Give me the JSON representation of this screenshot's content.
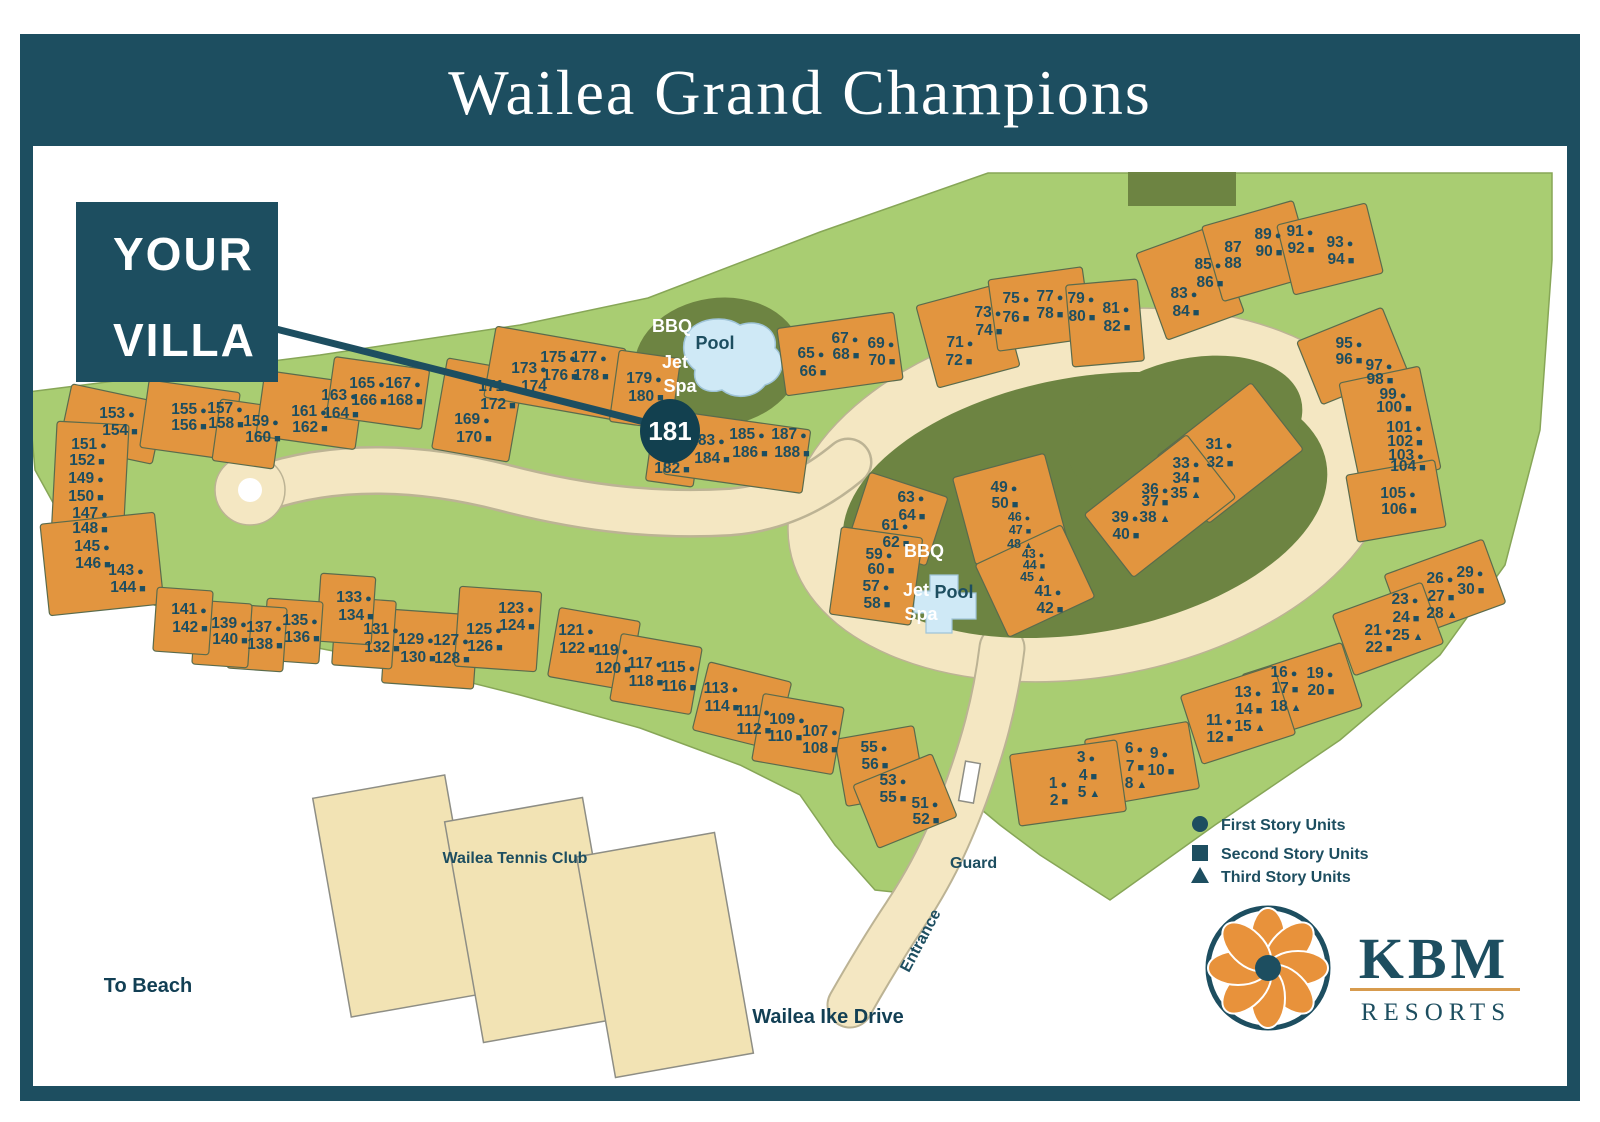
{
  "title": "Wailea Grand Champions",
  "callout": {
    "line1": "YOUR",
    "line2": "VILLA",
    "unit": "181"
  },
  "legend": [
    {
      "symbol": "circle",
      "label": "First Story Units"
    },
    {
      "symbol": "square",
      "label": "Second Story Units"
    },
    {
      "symbol": "triangle",
      "label": "Third Story Units"
    }
  ],
  "labels": {
    "bbq": "BBQ",
    "pool": "Pool",
    "jet": "Jet",
    "spa": "Spa",
    "tennis_club": "Wailea Tennis Club",
    "to_beach": "To Beach",
    "drive": "Wailea Ike Drive",
    "entrance": "Entrance",
    "guard": "Guard"
  },
  "logo": {
    "name": "KBM",
    "sub": "RESORTS"
  },
  "colors": {
    "header": "#1d4e60",
    "green": "#a9cd72",
    "green_edge": "#87a657",
    "olive": "#6d8442",
    "building": "#e2953f",
    "cream": "#f4e7c2",
    "pool": "#cfe9f6",
    "text": "#1d4e60",
    "logo_orange": "#e8923b"
  },
  "map": {
    "units": [
      [
        "1",
        1051,
        783,
        "c"
      ],
      [
        "2",
        1052,
        800,
        "s"
      ],
      [
        "3",
        1079,
        757,
        "c"
      ],
      [
        "4",
        1081,
        775,
        "s"
      ],
      [
        "5",
        1082,
        792,
        "t"
      ],
      [
        "6",
        1127,
        748,
        "c"
      ],
      [
        "7",
        1128,
        766,
        "s"
      ],
      [
        "8",
        1129,
        783,
        "t"
      ],
      [
        "9",
        1152,
        753,
        "c"
      ],
      [
        "10",
        1154,
        770,
        "s"
      ],
      [
        "11",
        1212,
        720,
        "c"
      ],
      [
        "12",
        1213,
        737,
        "s"
      ],
      [
        "13",
        1241,
        692,
        "c"
      ],
      [
        "14",
        1242,
        709,
        "s"
      ],
      [
        "15",
        1243,
        726,
        "t"
      ],
      [
        "16",
        1277,
        672,
        "c"
      ],
      [
        "17",
        1278,
        688,
        "s"
      ],
      [
        "18",
        1279,
        706,
        "t"
      ],
      [
        "19",
        1313,
        673,
        "c"
      ],
      [
        "20",
        1314,
        690,
        "s"
      ],
      [
        "21",
        1371,
        630,
        "c"
      ],
      [
        "22",
        1372,
        647,
        "s"
      ],
      [
        "23",
        1398,
        599,
        "c"
      ],
      [
        "24",
        1399,
        617,
        "s"
      ],
      [
        "25",
        1401,
        635,
        "t"
      ],
      [
        "26",
        1433,
        578,
        "c"
      ],
      [
        "27",
        1434,
        596,
        "s"
      ],
      [
        "28",
        1435,
        613,
        "t"
      ],
      [
        "29",
        1463,
        572,
        "c"
      ],
      [
        "30",
        1464,
        589,
        "s"
      ],
      [
        "31",
        1212,
        444,
        "c"
      ],
      [
        "32",
        1213,
        462,
        "s"
      ],
      [
        "33",
        1179,
        463,
        "c"
      ],
      [
        "34",
        1179,
        478,
        "s"
      ],
      [
        "35",
        1179,
        493,
        "t"
      ],
      [
        "36",
        1148,
        489,
        "c"
      ],
      [
        "37",
        1148,
        501,
        "s"
      ],
      [
        "38",
        1148,
        517,
        "t"
      ],
      [
        "39",
        1118,
        517,
        "c"
      ],
      [
        "40",
        1119,
        534,
        "s"
      ],
      [
        "41",
        1041,
        591,
        "c"
      ],
      [
        "42",
        1043,
        608,
        "s"
      ],
      [
        "43",
        1026,
        553,
        "c",
        1
      ],
      [
        "44",
        1027,
        564,
        "s",
        1
      ],
      [
        "45",
        1026,
        576,
        "t",
        1
      ],
      [
        "46",
        1012,
        516,
        "c",
        1
      ],
      [
        "47",
        1013,
        529,
        "s",
        1
      ],
      [
        "48",
        1013,
        543,
        "t",
        1
      ],
      [
        "49",
        997,
        487,
        "c"
      ],
      [
        "50",
        998,
        503,
        "s"
      ],
      [
        "51",
        918,
        803,
        "c"
      ],
      [
        "52",
        919,
        819,
        "s"
      ],
      [
        "53",
        886,
        780,
        "c"
      ],
      [
        "55",
        886,
        797,
        "s"
      ],
      [
        "55",
        867,
        747,
        "c"
      ],
      [
        "56",
        868,
        764,
        "s"
      ],
      [
        "57",
        869,
        586,
        "c"
      ],
      [
        "58",
        870,
        603,
        "s"
      ],
      [
        "59",
        872,
        554,
        "c"
      ],
      [
        "60",
        874,
        569,
        "s"
      ],
      [
        "61",
        888,
        525,
        "c"
      ],
      [
        "62",
        889,
        542,
        "s"
      ],
      [
        "63",
        904,
        497,
        "c"
      ],
      [
        "64",
        905,
        515,
        "s"
      ],
      [
        "65",
        804,
        353,
        "c"
      ],
      [
        "66",
        806,
        371,
        "s"
      ],
      [
        "67",
        838,
        338,
        "c"
      ],
      [
        "68",
        839,
        354,
        "s"
      ],
      [
        "69",
        874,
        343,
        "c"
      ],
      [
        "70",
        875,
        360,
        "s"
      ],
      [
        "71",
        953,
        342,
        "c"
      ],
      [
        "72",
        952,
        360,
        "s"
      ],
      [
        "73",
        981,
        312,
        "c"
      ],
      [
        "74",
        982,
        330,
        "s"
      ],
      [
        "75",
        1009,
        298,
        "c"
      ],
      [
        "76",
        1009,
        317,
        "s"
      ],
      [
        "77",
        1043,
        296,
        "c"
      ],
      [
        "78",
        1043,
        313,
        "s"
      ],
      [
        "79",
        1074,
        298,
        "c"
      ],
      [
        "80",
        1075,
        316,
        "s"
      ],
      [
        "81",
        1109,
        308,
        "c"
      ],
      [
        "82",
        1110,
        326,
        "s"
      ],
      [
        "83",
        1177,
        293,
        "c"
      ],
      [
        "84",
        1179,
        311,
        "s"
      ],
      [
        "85",
        1201,
        264,
        "c"
      ],
      [
        "86",
        1203,
        282,
        "s"
      ],
      [
        "87",
        1226,
        247,
        ""
      ],
      [
        "88",
        1226,
        263,
        ""
      ],
      [
        "89",
        1261,
        234,
        "c"
      ],
      [
        "90",
        1262,
        251,
        "s"
      ],
      [
        "91",
        1293,
        231,
        "c"
      ],
      [
        "92",
        1294,
        248,
        "s"
      ],
      [
        "93",
        1333,
        242,
        "c"
      ],
      [
        "94",
        1334,
        259,
        "s"
      ],
      [
        "95",
        1342,
        343,
        "c"
      ],
      [
        "96",
        1342,
        359,
        "s"
      ],
      [
        "97",
        1372,
        365,
        "c"
      ],
      [
        "98",
        1373,
        379,
        "s"
      ],
      [
        "99",
        1386,
        394,
        "c"
      ],
      [
        "100",
        1387,
        407,
        "s"
      ],
      [
        "101",
        1397,
        427,
        "c"
      ],
      [
        "102",
        1398,
        441,
        "s"
      ],
      [
        "103",
        1399,
        455,
        "c"
      ],
      [
        "104",
        1401,
        466,
        "s"
      ],
      [
        "105",
        1391,
        493,
        "c"
      ],
      [
        "106",
        1392,
        509,
        "s"
      ],
      [
        "107",
        813,
        731,
        "c"
      ],
      [
        "108",
        813,
        748,
        "s"
      ],
      [
        "109",
        780,
        719,
        "c"
      ],
      [
        "110",
        778,
        736,
        "s"
      ],
      [
        "111",
        746,
        711,
        "c"
      ],
      [
        "112",
        747,
        729,
        "s"
      ],
      [
        "113",
        714,
        688,
        "c"
      ],
      [
        "114",
        715,
        706,
        "s"
      ],
      [
        "115",
        671,
        667,
        "c"
      ],
      [
        "116",
        672,
        686,
        "s"
      ],
      [
        "117",
        638,
        663,
        "c"
      ],
      [
        "118",
        639,
        681,
        "s"
      ],
      [
        "119",
        604,
        650,
        "c"
      ],
      [
        "120",
        606,
        668,
        "s"
      ],
      [
        "121",
        569,
        630,
        "c"
      ],
      [
        "122",
        570,
        648,
        "s"
      ],
      [
        "123",
        509,
        608,
        "c"
      ],
      [
        "124",
        510,
        625,
        "s"
      ],
      [
        "125",
        477,
        629,
        "c"
      ],
      [
        "126",
        478,
        646,
        "s"
      ],
      [
        "127",
        444,
        640,
        "c"
      ],
      [
        "128",
        445,
        658,
        "s"
      ],
      [
        "129",
        409,
        639,
        "c"
      ],
      [
        "130",
        411,
        657,
        "s"
      ],
      [
        "131",
        374,
        629,
        "c"
      ],
      [
        "132",
        375,
        647,
        "s"
      ],
      [
        "133",
        347,
        597,
        "c"
      ],
      [
        "134",
        349,
        615,
        "s"
      ],
      [
        "135",
        293,
        620,
        "c"
      ],
      [
        "136",
        295,
        637,
        "s"
      ],
      [
        "137",
        257,
        627,
        "c"
      ],
      [
        "138",
        258,
        644,
        "s"
      ],
      [
        "139",
        222,
        623,
        "c"
      ],
      [
        "140",
        223,
        639,
        "s"
      ],
      [
        "141",
        182,
        609,
        "c"
      ],
      [
        "142",
        183,
        627,
        "s"
      ],
      [
        "143",
        119,
        570,
        "c"
      ],
      [
        "144",
        121,
        587,
        "s"
      ],
      [
        "145",
        85,
        546,
        "c"
      ],
      [
        "146",
        86,
        563,
        "s"
      ],
      [
        "147",
        83,
        513,
        "c"
      ],
      [
        "148",
        83,
        528,
        "s"
      ],
      [
        "149",
        79,
        478,
        "c"
      ],
      [
        "150",
        79,
        496,
        "s"
      ],
      [
        "151",
        82,
        444,
        "c"
      ],
      [
        "152",
        80,
        460,
        "s"
      ],
      [
        "153",
        110,
        413,
        "c"
      ],
      [
        "154",
        113,
        430,
        "s"
      ],
      [
        "155",
        182,
        409,
        "c"
      ],
      [
        "156",
        182,
        425,
        "s"
      ],
      [
        "157",
        218,
        408,
        "c"
      ],
      [
        "158",
        219,
        423,
        "s"
      ],
      [
        "159",
        254,
        421,
        "c"
      ],
      [
        "160",
        256,
        437,
        "s"
      ],
      [
        "161",
        302,
        411,
        "c"
      ],
      [
        "162",
        303,
        427,
        "s"
      ],
      [
        "163",
        332,
        395,
        "c"
      ],
      [
        "164",
        334,
        413,
        "s"
      ],
      [
        "165",
        360,
        383,
        "c"
      ],
      [
        "166",
        362,
        400,
        "s"
      ],
      [
        "167",
        396,
        383,
        "c"
      ],
      [
        "168",
        398,
        400,
        "s"
      ],
      [
        "169",
        465,
        419,
        "c"
      ],
      [
        "170",
        467,
        437,
        "s"
      ],
      [
        "171",
        489,
        386,
        "c"
      ],
      [
        "172",
        491,
        404,
        "s"
      ],
      [
        "173",
        522,
        368,
        "c"
      ],
      [
        "174",
        527,
        386,
        ""
      ],
      [
        "175",
        551,
        357,
        "c"
      ],
      [
        "176",
        553,
        375,
        "s"
      ],
      [
        "177",
        582,
        357,
        "c"
      ],
      [
        "178",
        584,
        375,
        "s"
      ],
      [
        "179",
        637,
        378,
        "c"
      ],
      [
        "180",
        639,
        396,
        "s"
      ],
      [
        "182",
        665,
        468,
        "s"
      ],
      [
        "183",
        700,
        440,
        "c"
      ],
      [
        "184",
        705,
        458,
        "s"
      ],
      [
        "185",
        740,
        434,
        "c"
      ],
      [
        "186",
        743,
        452,
        "s"
      ],
      [
        "187",
        782,
        434,
        "c"
      ],
      [
        "188",
        785,
        452,
        "s"
      ]
    ],
    "buildings": [
      [
        112,
        424,
        95,
        62,
        12
      ],
      [
        90,
        482,
        72,
        118,
        3
      ],
      [
        102,
        564,
        115,
        92,
        -6
      ],
      [
        190,
        420,
        92,
        68,
        8
      ],
      [
        247,
        434,
        62,
        62,
        8
      ],
      [
        310,
        410,
        100,
        66,
        8
      ],
      [
        378,
        393,
        96,
        60,
        8
      ],
      [
        478,
        410,
        78,
        92,
        10
      ],
      [
        555,
        373,
        132,
        72,
        10
      ],
      [
        645,
        390,
        62,
        72,
        8
      ],
      [
        672,
        464,
        48,
        40,
        8
      ],
      [
        737,
        452,
        140,
        64,
        8
      ],
      [
        840,
        354,
        118,
        68,
        -8
      ],
      [
        968,
        336,
        85,
        85,
        -15
      ],
      [
        1040,
        309,
        95,
        72,
        -8
      ],
      [
        1105,
        323,
        72,
        82,
        -5
      ],
      [
        1190,
        283,
        82,
        92,
        -20
      ],
      [
        1258,
        251,
        95,
        78,
        -16
      ],
      [
        1330,
        249,
        92,
        72,
        -14
      ],
      [
        1352,
        356,
        92,
        68,
        -22
      ],
      [
        1390,
        426,
        82,
        105,
        -12
      ],
      [
        1396,
        501,
        90,
        68,
        -10
      ],
      [
        1230,
        453,
        120,
        85,
        -38
      ],
      [
        1160,
        506,
        130,
        80,
        -38
      ],
      [
        1010,
        509,
        95,
        90,
        -15
      ],
      [
        1035,
        581,
        95,
        80,
        -25
      ],
      [
        898,
        519,
        82,
        72,
        18
      ],
      [
        876,
        576,
        82,
        88,
        8
      ],
      [
        1445,
        589,
        105,
        68,
        -20
      ],
      [
        1388,
        629,
        95,
        65,
        -20
      ],
      [
        1302,
        691,
        105,
        68,
        -18
      ],
      [
        1238,
        715,
        98,
        72,
        -18
      ],
      [
        1142,
        764,
        105,
        68,
        -10
      ],
      [
        1068,
        783,
        108,
        72,
        -8
      ],
      [
        880,
        766,
        80,
        68,
        -10
      ],
      [
        905,
        801,
        85,
        68,
        -22
      ],
      [
        742,
        706,
        85,
        70,
        14
      ],
      [
        798,
        734,
        82,
        68,
        10
      ],
      [
        594,
        649,
        82,
        70,
        10
      ],
      [
        656,
        674,
        82,
        68,
        10
      ],
      [
        430,
        649,
        92,
        74,
        4
      ],
      [
        498,
        629,
        82,
        80,
        4
      ],
      [
        364,
        633,
        60,
        68,
        4
      ],
      [
        346,
        609,
        55,
        68,
        4
      ],
      [
        293,
        631,
        56,
        62,
        4
      ],
      [
        257,
        638,
        56,
        64,
        4
      ],
      [
        222,
        634,
        56,
        64,
        4
      ],
      [
        183,
        621,
        56,
        64,
        4
      ]
    ]
  }
}
